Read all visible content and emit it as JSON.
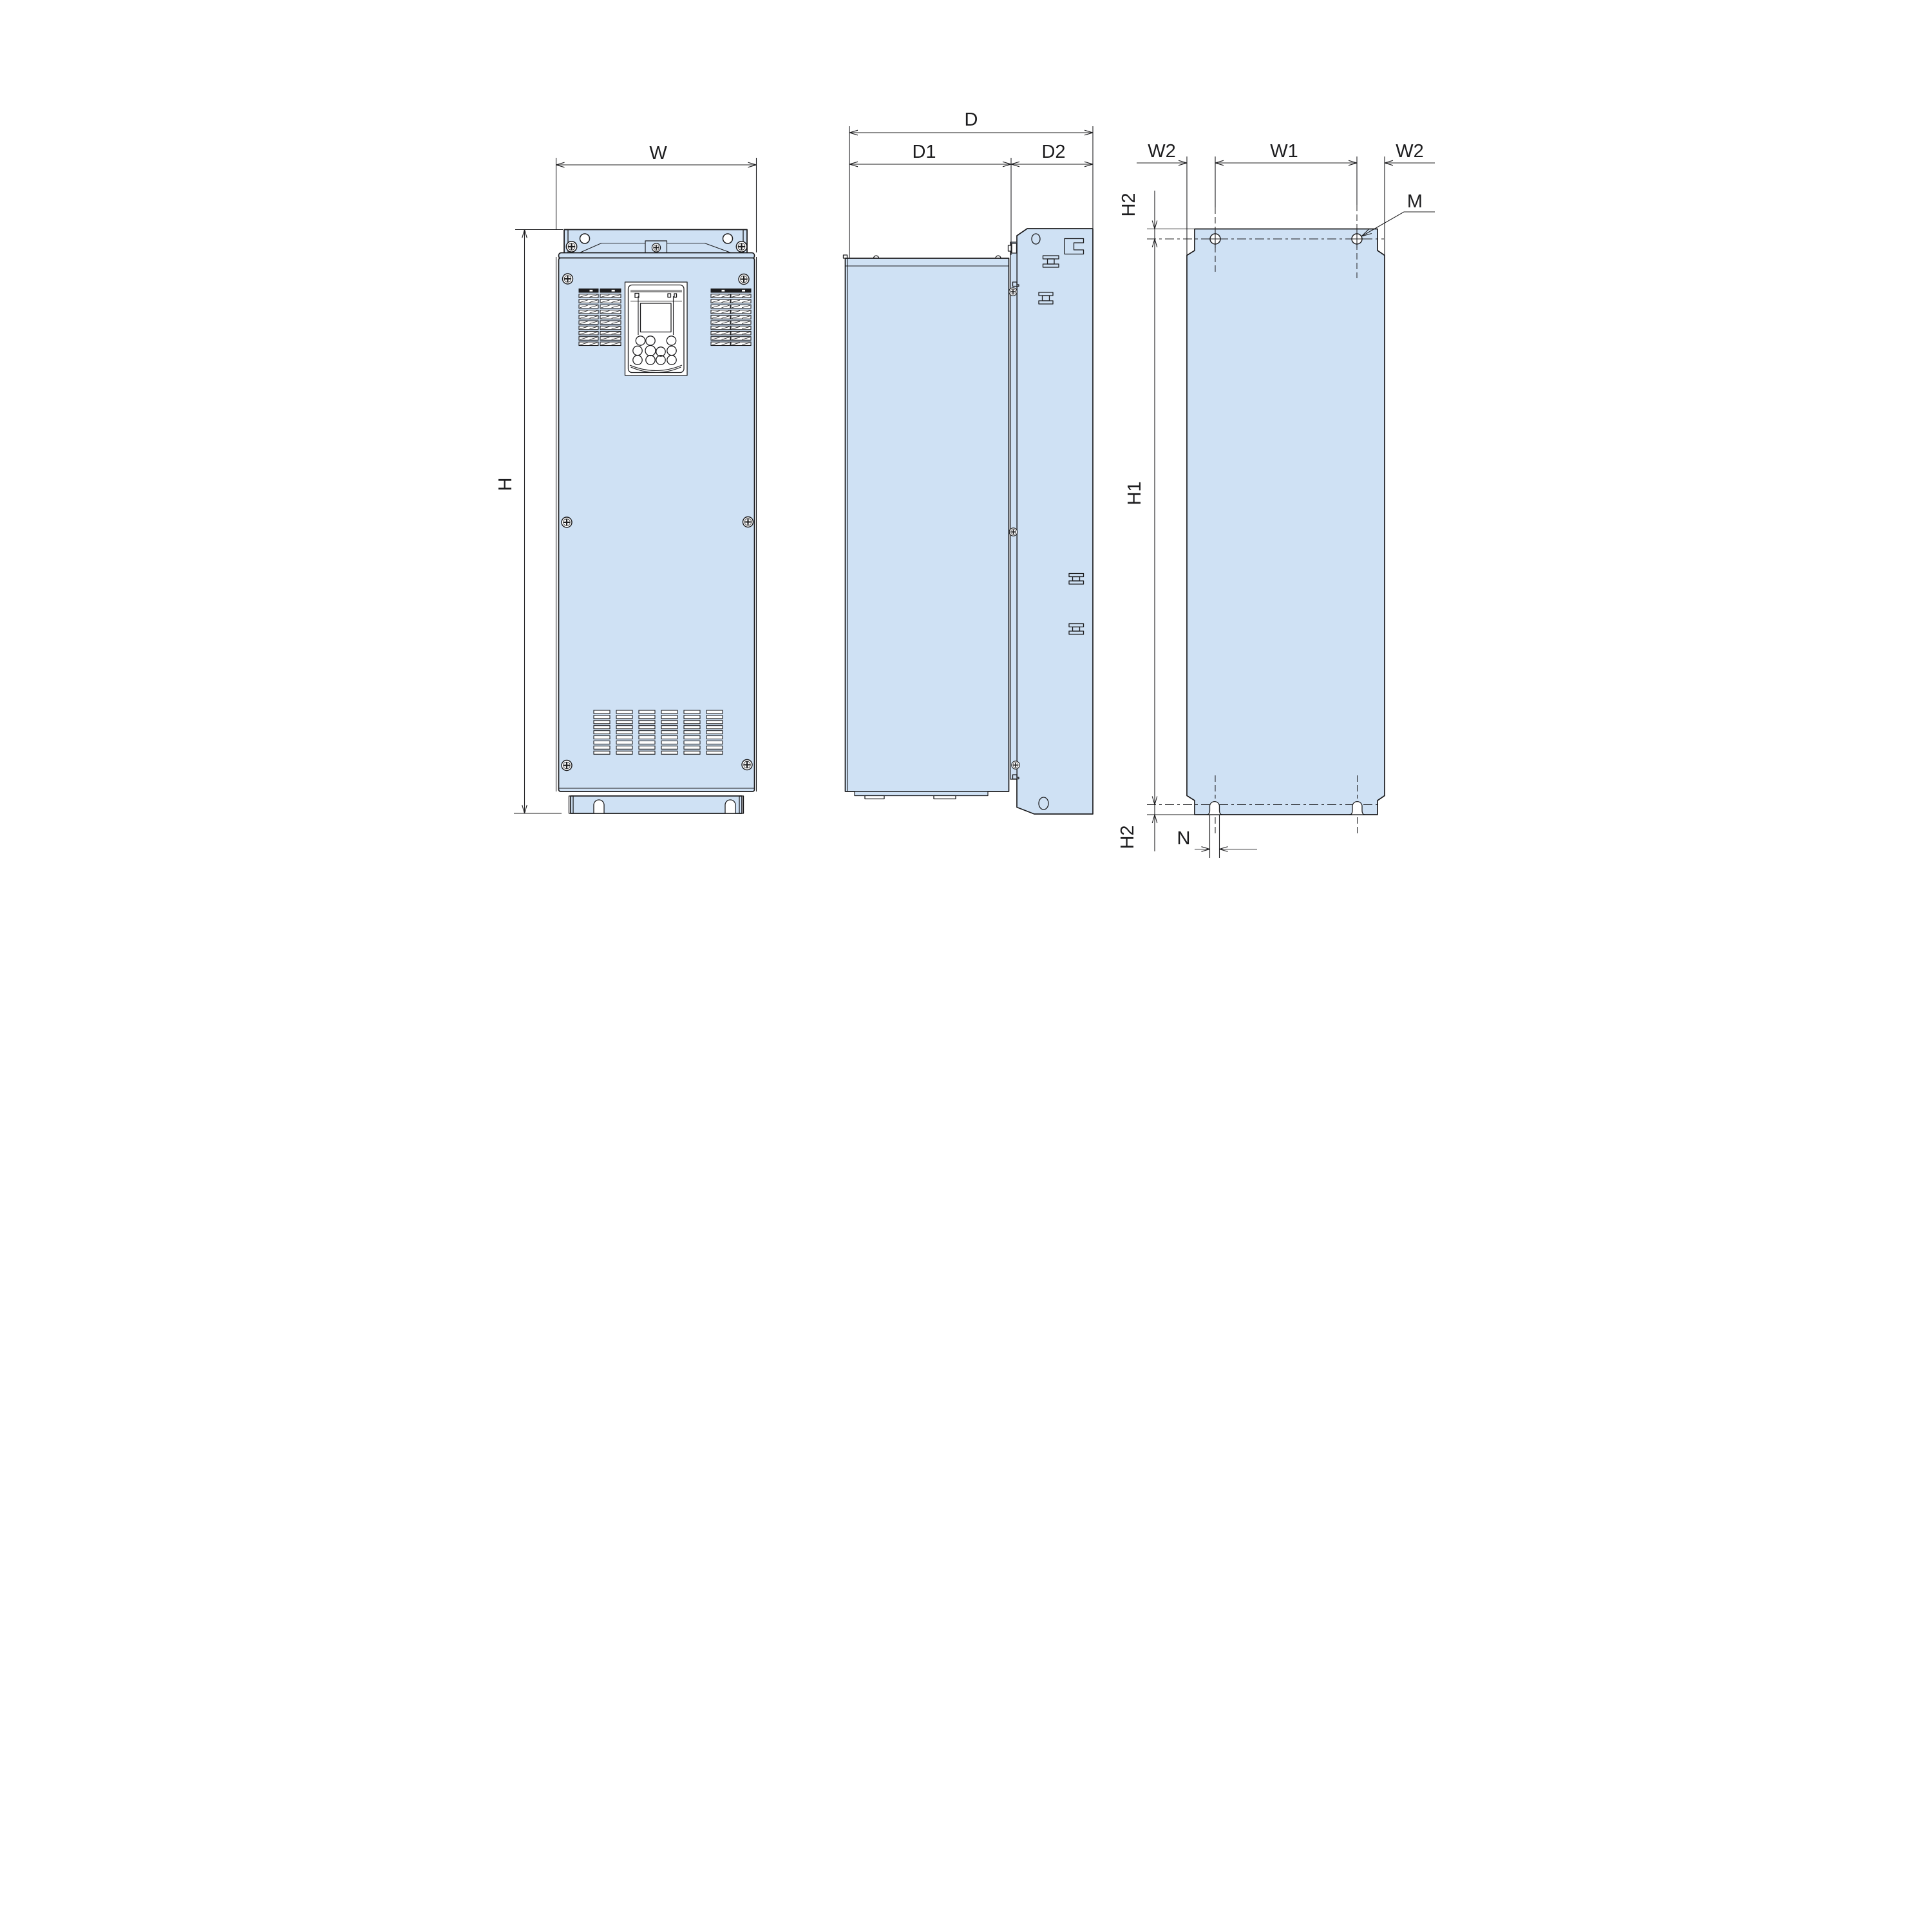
{
  "document": {
    "kind": "outline-dimension-drawing",
    "labels": {
      "w": "W",
      "h": "H",
      "d": "D",
      "d1": "D1",
      "d2": "D2",
      "w1": "W1",
      "w2_left": "W2",
      "w2_right": "W2",
      "h1": "H1",
      "h2_top": "H2",
      "h2_bottom": "H2",
      "m": "M",
      "n": "N"
    },
    "colors": {
      "background": "#ffffff",
      "panel_fill": "#cfe1f4",
      "line": "#1c1c1e"
    }
  }
}
